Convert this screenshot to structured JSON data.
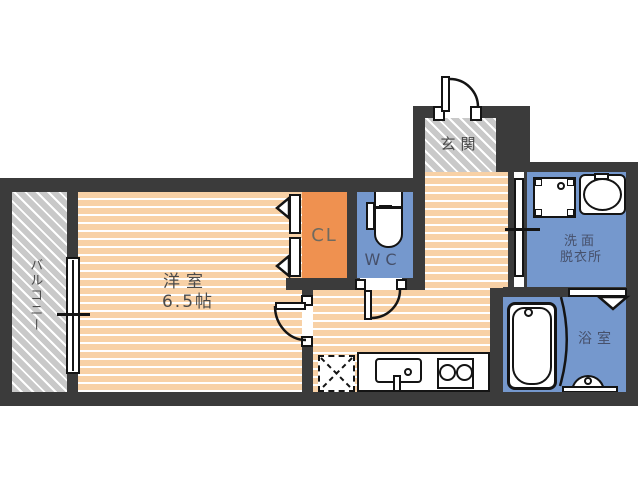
{
  "plan": {
    "title": "apartment-floor-plan",
    "rooms": {
      "balcony": {
        "label": "バルコニー"
      },
      "bedroom": {
        "label": "洋室",
        "size": "6.5帖"
      },
      "closet": {
        "label": "CL"
      },
      "toilet": {
        "label": "WC"
      },
      "entrance": {
        "label": "玄関"
      },
      "washroom": {
        "label_line1": "洗面",
        "label_line2": "脱衣所"
      },
      "bathroom": {
        "label": "浴室"
      }
    },
    "colors": {
      "wall": "#3b3b3b",
      "wood_floor": "#f8d1a6",
      "closet_fill": "#ef9150",
      "wet_area_fill": "#7598cd",
      "balcony_fill": "#c9c9c9",
      "label_text": "#4a4a4a"
    },
    "fixtures": {
      "entrance_door": "swing-door-icon",
      "bedroom_door": "swing-door-icon",
      "wc_door": "swing-door-icon",
      "closet_doors": "folding-door-icon",
      "washroom_door": "sliding-door-icon",
      "bathroom_door": "folding-door-icon",
      "balcony_window": "sliding-window-icon",
      "washing_machine_pan": "washer-pan-icon",
      "wash_basin": "sink-icon",
      "toilet": "toilet-icon",
      "bathtub": "bathtub-icon",
      "kitchen_sink": "kitchen-sink-icon",
      "stove": "two-burner-stove-icon",
      "refrigerator_space": "fridge-space-icon"
    }
  }
}
